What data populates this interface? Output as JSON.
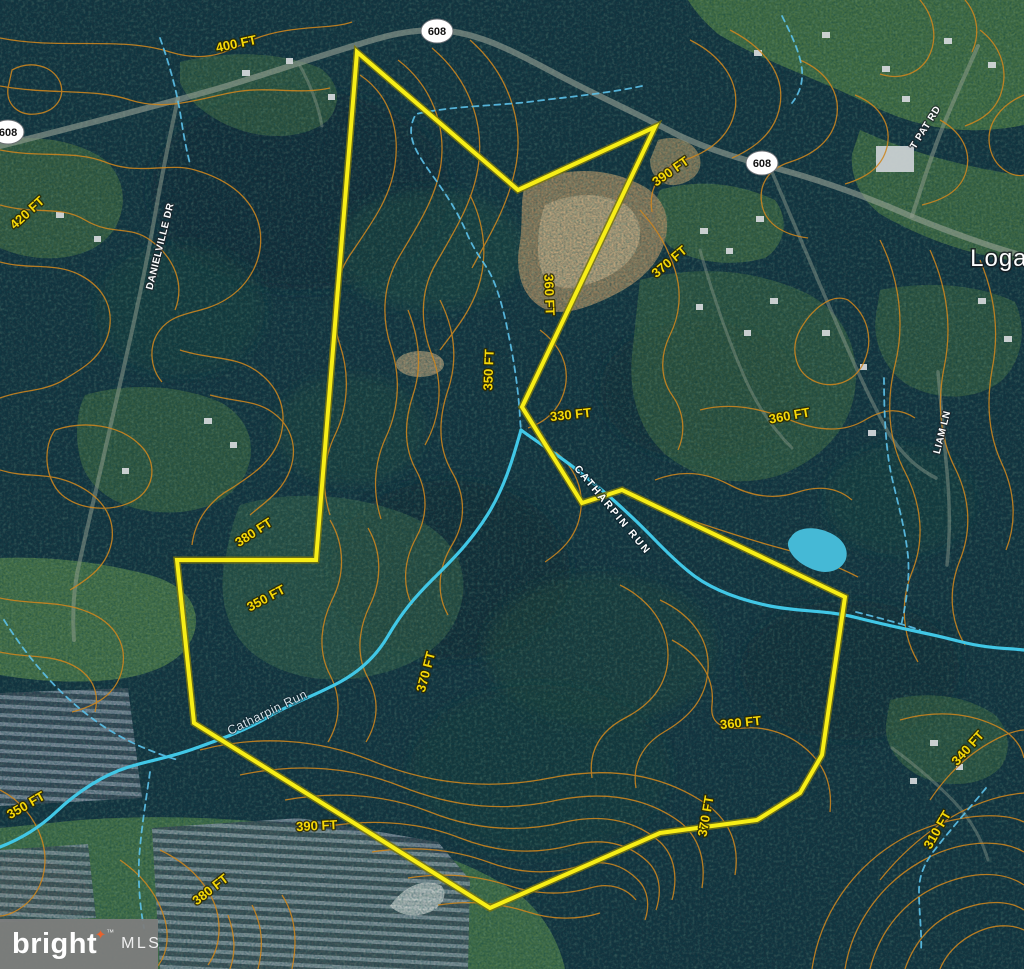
{
  "map": {
    "kind": "satellite-topographic-parcel-map",
    "route_shields": [
      {
        "route": "608",
        "position": "left-edge"
      },
      {
        "route": "608",
        "position": "top-center"
      },
      {
        "route": "608",
        "position": "upper-right"
      }
    ],
    "place_labels": [
      {
        "text": "Logan"
      }
    ],
    "street_labels": [
      {
        "text": "DANIELVILLE DR"
      },
      {
        "text": "T PAT RD"
      },
      {
        "text": "LIAM LN"
      }
    ],
    "water_labels": [
      {
        "text": "CATHARPIN RUN"
      },
      {
        "text": "Catharpin Run"
      }
    ],
    "elevation_labels": [
      {
        "text": "400 FT"
      },
      {
        "text": "420 FT"
      },
      {
        "text": "390 FT"
      },
      {
        "text": "370 FT"
      },
      {
        "text": "360 FT"
      },
      {
        "text": "350 FT"
      },
      {
        "text": "330 FT"
      },
      {
        "text": "360 FT"
      },
      {
        "text": "380 FT"
      },
      {
        "text": "350 FT"
      },
      {
        "text": "370 FT"
      },
      {
        "text": "360 FT"
      },
      {
        "text": "350 FT"
      },
      {
        "text": "390 FT"
      },
      {
        "text": "370 FT"
      },
      {
        "text": "340 FT"
      },
      {
        "text": "310 FT"
      },
      {
        "text": "380 FT"
      }
    ],
    "colors": {
      "parcel_boundary": "#f7ee17",
      "contour_line": "#cd861f",
      "stream": "#41c7e6",
      "elevation_text": "#f6d808"
    },
    "logo": {
      "brand": "bright",
      "star": "✦",
      "tm": "™",
      "suffix": "MLS"
    }
  }
}
